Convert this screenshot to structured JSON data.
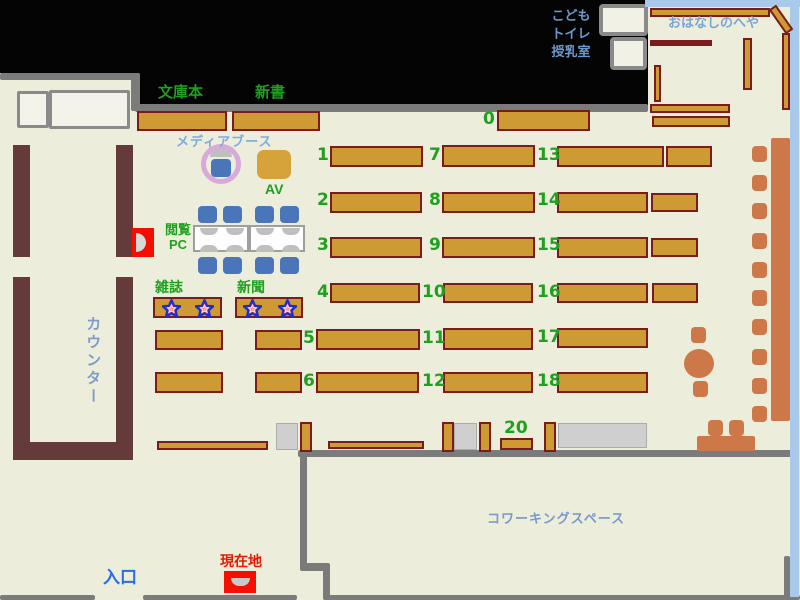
{
  "title": "library-floor-map",
  "labels": {
    "paperback": "文庫本",
    "new_books": "新書",
    "media_booth": "メディアブース",
    "av": "AV",
    "reading_pc": "閲覧\nPC",
    "magazines": "雑誌",
    "newspapers": "新聞",
    "counter": "カウンター",
    "kids_block": "こども\nトイレ\n授乳室",
    "story_room": "おはなしのへや",
    "coworking": "コワーキングスペース",
    "entrance": "入口",
    "current_location": "現在地"
  },
  "colors": {
    "floor": "#ECEDDB",
    "wall_gray": "#7B7B7B",
    "window_blue": "#A9C9EA",
    "counter_brown": "#653A3A",
    "shelf_fill": "#CE9A33",
    "shelf_border": "#7B1C1C",
    "orange_furniture": "#CC7848",
    "chair_blue": "#4A76B9",
    "ring_pink": "#D9A9D9",
    "label_green": "#1FA01F",
    "label_blue": "#7FAADD",
    "entrance_blue": "#2A6BE8",
    "location_red": "#F50F00"
  },
  "map": {
    "black": [
      [
        0,
        0,
        140,
        73
      ],
      [
        135,
        0,
        513,
        105
      ]
    ],
    "walls": [
      [
        0,
        73,
        140,
        7
      ],
      [
        131,
        73,
        9,
        38
      ],
      [
        135,
        104,
        513,
        8
      ],
      [
        298,
        450,
        494,
        7
      ],
      [
        300,
        450,
        7,
        120
      ],
      [
        300,
        563,
        30,
        8
      ],
      [
        323,
        566,
        7,
        34
      ],
      [
        0,
        595,
        95,
        5
      ],
      [
        143,
        595,
        154,
        5
      ],
      [
        325,
        595,
        475,
        5
      ],
      [
        790,
        210,
        9,
        19
      ],
      [
        784,
        556,
        6,
        41
      ]
    ],
    "blue_walls": [
      [
        645,
        0,
        155,
        7
      ],
      [
        790,
        0,
        9,
        597
      ]
    ],
    "white_rooms": [
      [
        17,
        91,
        32,
        37
      ],
      [
        49,
        90,
        81,
        39
      ]
    ],
    "kids_rooms": [
      [
        599,
        4,
        49,
        32
      ],
      [
        610,
        37,
        37,
        33
      ]
    ],
    "counter": [
      [
        13,
        145,
        17,
        112
      ],
      [
        116,
        145,
        17,
        112
      ],
      [
        13,
        277,
        17,
        183
      ],
      [
        116,
        277,
        17,
        183
      ],
      [
        13,
        442,
        120,
        18
      ]
    ],
    "shelves": [
      {
        "x": 137,
        "y": 111,
        "w": 90,
        "h": 20,
        "n": "shelf-paperback"
      },
      {
        "x": 232,
        "y": 111,
        "w": 88,
        "h": 20,
        "n": "shelf-new-books"
      },
      {
        "x": 497,
        "y": 110,
        "w": 93,
        "h": 21,
        "n": "shelf-0"
      },
      {
        "x": 330,
        "y": 146,
        "w": 93,
        "h": 21,
        "n": "shelf-1"
      },
      {
        "x": 330,
        "y": 192,
        "w": 92,
        "h": 21,
        "n": "shelf-2"
      },
      {
        "x": 330,
        "y": 237,
        "w": 92,
        "h": 21,
        "n": "shelf-3"
      },
      {
        "x": 330,
        "y": 283,
        "w": 90,
        "h": 20,
        "n": "shelf-4"
      },
      {
        "x": 316,
        "y": 329,
        "w": 104,
        "h": 21,
        "n": "shelf-5"
      },
      {
        "x": 316,
        "y": 372,
        "w": 103,
        "h": 21,
        "n": "shelf-6"
      },
      {
        "x": 442,
        "y": 145,
        "w": 93,
        "h": 22,
        "n": "shelf-7"
      },
      {
        "x": 442,
        "y": 192,
        "w": 93,
        "h": 21,
        "n": "shelf-8"
      },
      {
        "x": 442,
        "y": 237,
        "w": 93,
        "h": 21,
        "n": "shelf-9"
      },
      {
        "x": 443,
        "y": 283,
        "w": 90,
        "h": 20,
        "n": "shelf-10"
      },
      {
        "x": 443,
        "y": 328,
        "w": 90,
        "h": 22,
        "n": "shelf-11"
      },
      {
        "x": 443,
        "y": 372,
        "w": 90,
        "h": 21,
        "n": "shelf-12"
      },
      {
        "x": 557,
        "y": 146,
        "w": 107,
        "h": 21,
        "n": "shelf-13"
      },
      {
        "x": 666,
        "y": 146,
        "w": 46,
        "h": 21,
        "n": "shelf-13b"
      },
      {
        "x": 557,
        "y": 192,
        "w": 91,
        "h": 21,
        "n": "shelf-14"
      },
      {
        "x": 651,
        "y": 193,
        "w": 47,
        "h": 19,
        "n": "shelf-14b"
      },
      {
        "x": 557,
        "y": 237,
        "w": 91,
        "h": 21,
        "n": "shelf-15"
      },
      {
        "x": 651,
        "y": 238,
        "w": 47,
        "h": 19,
        "n": "shelf-15b"
      },
      {
        "x": 557,
        "y": 283,
        "w": 91,
        "h": 20,
        "n": "shelf-16"
      },
      {
        "x": 652,
        "y": 283,
        "w": 46,
        "h": 20,
        "n": "shelf-16b"
      },
      {
        "x": 557,
        "y": 328,
        "w": 91,
        "h": 20,
        "n": "shelf-17"
      },
      {
        "x": 557,
        "y": 372,
        "w": 91,
        "h": 21,
        "n": "shelf-18"
      },
      {
        "x": 153,
        "y": 297,
        "w": 69,
        "h": 21,
        "n": "shelf-magazines"
      },
      {
        "x": 235,
        "y": 297,
        "w": 68,
        "h": 21,
        "n": "shelf-newspapers"
      },
      {
        "x": 155,
        "y": 330,
        "w": 68,
        "h": 20,
        "n": "shelf-row5-left"
      },
      {
        "x": 255,
        "y": 330,
        "w": 47,
        "h": 20,
        "n": "shelf-row5-mid"
      },
      {
        "x": 155,
        "y": 372,
        "w": 68,
        "h": 21,
        "n": "shelf-row6-left"
      },
      {
        "x": 255,
        "y": 372,
        "w": 47,
        "h": 21,
        "n": "shelf-row6-mid"
      },
      {
        "x": 650,
        "y": 104,
        "w": 80,
        "h": 9,
        "n": "shelf-storyroom-lower1"
      },
      {
        "x": 652,
        "y": 116,
        "w": 78,
        "h": 11,
        "n": "shelf-storyroom-lower2"
      },
      {
        "x": 650,
        "y": 8,
        "w": 120,
        "h": 9,
        "n": "shelf-storyroom-top"
      },
      {
        "x": 766,
        "y": 15,
        "w": 30,
        "h": 9,
        "rot": 55,
        "n": "shelf-storyroom-diagonal"
      },
      {
        "x": 782,
        "y": 33,
        "w": 8,
        "h": 77,
        "n": "shelf-storyroom-right"
      },
      {
        "x": 743,
        "y": 38,
        "w": 9,
        "h": 52,
        "n": "shelf-storyroom-mid"
      },
      {
        "x": 654,
        "y": 65,
        "w": 7,
        "h": 37,
        "n": "shelf-storyroom-left"
      },
      {
        "x": 300,
        "y": 422,
        "w": 12,
        "h": 30,
        "n": "shelf-end-1"
      },
      {
        "x": 442,
        "y": 422,
        "w": 12,
        "h": 30,
        "n": "shelf-end-2"
      },
      {
        "x": 479,
        "y": 422,
        "w": 12,
        "h": 30,
        "n": "shelf-end-3"
      },
      {
        "x": 544,
        "y": 422,
        "w": 12,
        "h": 30,
        "n": "shelf-end-4"
      },
      {
        "x": 157,
        "y": 441,
        "w": 111,
        "h": 9,
        "n": "shelf-low-left"
      },
      {
        "x": 328,
        "y": 441,
        "w": 96,
        "h": 8,
        "n": "shelf-low-mid"
      },
      {
        "x": 500,
        "y": 438,
        "w": 33,
        "h": 12,
        "n": "shelf-20"
      }
    ],
    "dark_shelves": [
      [
        650,
        40,
        62,
        6
      ]
    ],
    "gray_tables": [
      [
        276,
        423,
        22,
        27
      ],
      [
        454,
        423,
        23,
        27
      ],
      [
        558,
        423,
        89,
        25
      ]
    ],
    "orange_rects": [
      [
        771,
        138,
        19,
        283
      ],
      [
        697,
        436,
        58,
        15
      ]
    ],
    "orange_round": [
      [
        684,
        349,
        30,
        29
      ]
    ],
    "orange_stools": [
      [
        752,
        146
      ],
      [
        752,
        175
      ],
      [
        752,
        203
      ],
      [
        752,
        233
      ],
      [
        752,
        262
      ],
      [
        752,
        290
      ],
      [
        752,
        319
      ],
      [
        752,
        349
      ],
      [
        752,
        378
      ],
      [
        752,
        406
      ],
      [
        691,
        327
      ],
      [
        693,
        381
      ],
      [
        708,
        420
      ],
      [
        729,
        420
      ]
    ],
    "blue_chairs": [
      [
        198,
        206
      ],
      [
        223,
        206
      ],
      [
        255,
        206
      ],
      [
        280,
        206
      ],
      [
        198,
        257
      ],
      [
        223,
        257
      ],
      [
        255,
        257
      ],
      [
        280,
        257
      ]
    ],
    "media_chair": [
      211,
      159,
      20,
      18
    ],
    "pc_tables": [
      [
        193,
        225,
        56,
        27
      ],
      [
        249,
        225,
        56,
        27
      ]
    ],
    "moons_down": [
      [
        200,
        228
      ],
      [
        226,
        228
      ],
      [
        256,
        228
      ],
      [
        282,
        228
      ]
    ],
    "moons_up": [
      [
        200,
        245
      ],
      [
        226,
        245
      ],
      [
        256,
        245
      ],
      [
        282,
        245
      ]
    ],
    "ring_moon": [
      210,
      148,
      22,
      9
    ],
    "ring": [
      201,
      144,
      40,
      40
    ],
    "av_box": [
      257,
      150,
      34,
      29
    ],
    "numbers": [
      {
        "t": "0",
        "x": 483,
        "y": 111
      },
      {
        "t": "1",
        "x": 317,
        "y": 147
      },
      {
        "t": "2",
        "x": 317,
        "y": 192
      },
      {
        "t": "3",
        "x": 317,
        "y": 237
      },
      {
        "t": "4",
        "x": 317,
        "y": 284
      },
      {
        "t": "5",
        "x": 303,
        "y": 330
      },
      {
        "t": "6",
        "x": 303,
        "y": 373
      },
      {
        "t": "7",
        "x": 429,
        "y": 147
      },
      {
        "t": "8",
        "x": 429,
        "y": 192
      },
      {
        "t": "9",
        "x": 429,
        "y": 237
      },
      {
        "t": "10",
        "x": 422,
        "y": 284
      },
      {
        "t": "11",
        "x": 422,
        "y": 330
      },
      {
        "t": "12",
        "x": 422,
        "y": 373
      },
      {
        "t": "13",
        "x": 537,
        "y": 147
      },
      {
        "t": "14",
        "x": 537,
        "y": 192
      },
      {
        "t": "15",
        "x": 537,
        "y": 237
      },
      {
        "t": "16",
        "x": 537,
        "y": 284
      },
      {
        "t": "17",
        "x": 537,
        "y": 329
      },
      {
        "t": "18",
        "x": 537,
        "y": 373
      },
      {
        "t": "20",
        "x": 504,
        "y": 420
      }
    ],
    "stars": [
      [
        162,
        299
      ],
      [
        195,
        299
      ],
      [
        243,
        299
      ],
      [
        278,
        299
      ]
    ]
  }
}
